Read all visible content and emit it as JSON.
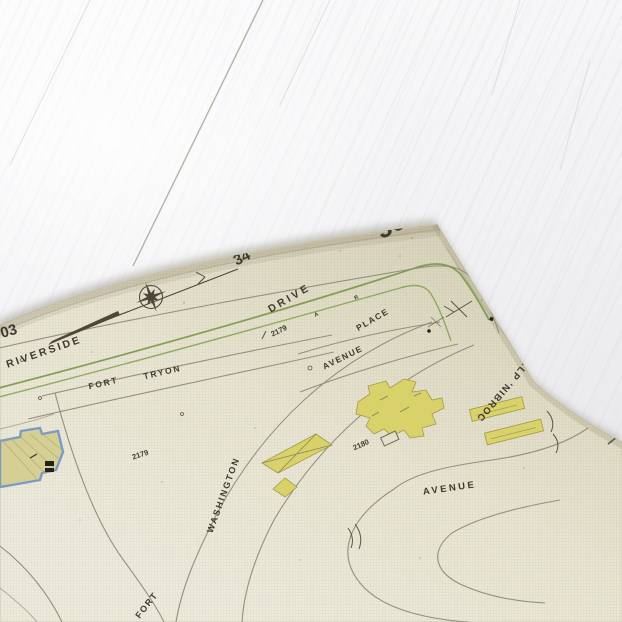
{
  "scene": {
    "description_labels": {
      "sheet_number": "36",
      "adjacent_sheet_number": "34",
      "edge_sheet_number": "03"
    },
    "streets": {
      "riverside": "RIVERSIDE",
      "drive": "DRIVE",
      "fort_tryon_word1": "FORT",
      "fort_tryon_word2": "TRYON",
      "place_upper": "PLACE",
      "corbin_place": "CORBIN' PLACE",
      "avenue_upper": "AVENUE",
      "washington": "WASHINGTON",
      "avenue_lower": "AVENUE",
      "fort_lower": "FORT"
    },
    "block_numbers": {
      "block_2179_upper": "2179",
      "block_2179_lower": "2179",
      "block_2180": "2180"
    },
    "small_marks": {
      "mark_a": "A",
      "mark_r": "R"
    },
    "colors": {
      "paper": "#e7e3d0",
      "paper_dark_edge": "#d7d2ba",
      "ink": "#3e3a2f",
      "road_line": "#93907f",
      "parkway_green": "#7c9a4d",
      "building_yellow": "#d9d26b",
      "building_blue_outline": "#7b9bc3",
      "wood_white": "#f4f4f6"
    }
  }
}
